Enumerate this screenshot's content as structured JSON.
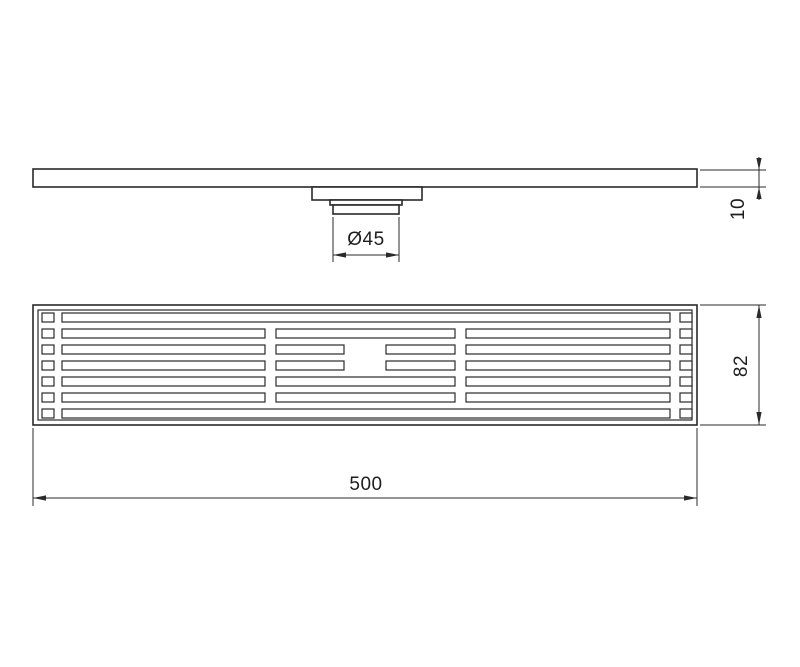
{
  "drawing": {
    "type": "technical-drawing",
    "subject": "linear-shower-drain",
    "background_color": "#ffffff",
    "line_color": "#2a2a2a",
    "dimensions": {
      "outlet_diameter": "Ø45",
      "profile_height": "10",
      "drain_length": "500",
      "drain_width": "82"
    }
  }
}
